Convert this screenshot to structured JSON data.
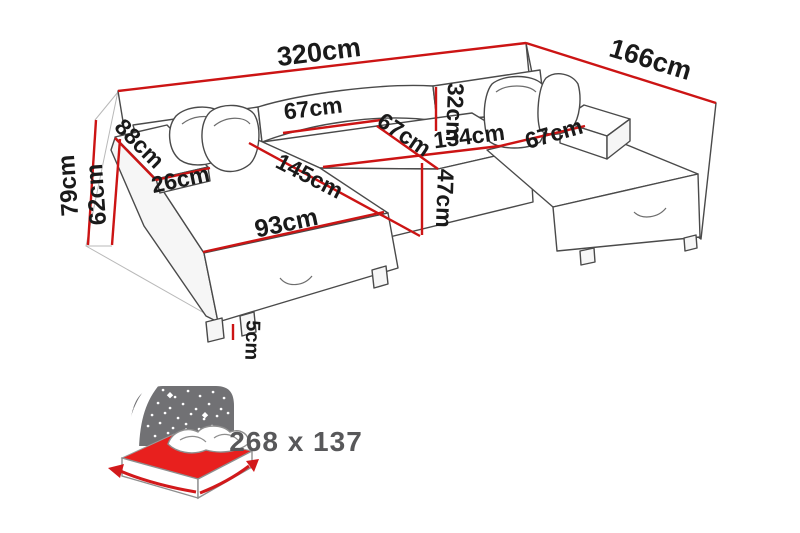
{
  "diagram": {
    "type": "corner-sofa-dimension-diagram",
    "dimensions": {
      "total_width": "320cm",
      "total_depth": "166cm",
      "total_height": "79cm",
      "armrest_height": "62cm",
      "armrest_length": "88cm",
      "armrest_width": "26cm",
      "back_cushion_width": "67cm",
      "middle_seat_depth": "67cm",
      "backrest_height": "32cm",
      "middle_seat_width": "134cm",
      "right_seat_width": "67cm",
      "chaise_length": "145cm",
      "seat_height": "47cm",
      "chaise_width": "93cm",
      "leg_height": "5cm"
    }
  },
  "sleeping_icon": {
    "icon": "sofa-bed-sleeping-area-icon",
    "sleeping_area": "268 x 137"
  },
  "colors": {
    "dimension_line": "#cc1414",
    "label_text": "#1a1a1a",
    "outline": "#4a4a4a",
    "icon_gray": "#717174",
    "icon_red": "#e8201e",
    "icon_arrow": "#d2191b",
    "icon_text": "#58585a",
    "background": "#ffffff"
  }
}
